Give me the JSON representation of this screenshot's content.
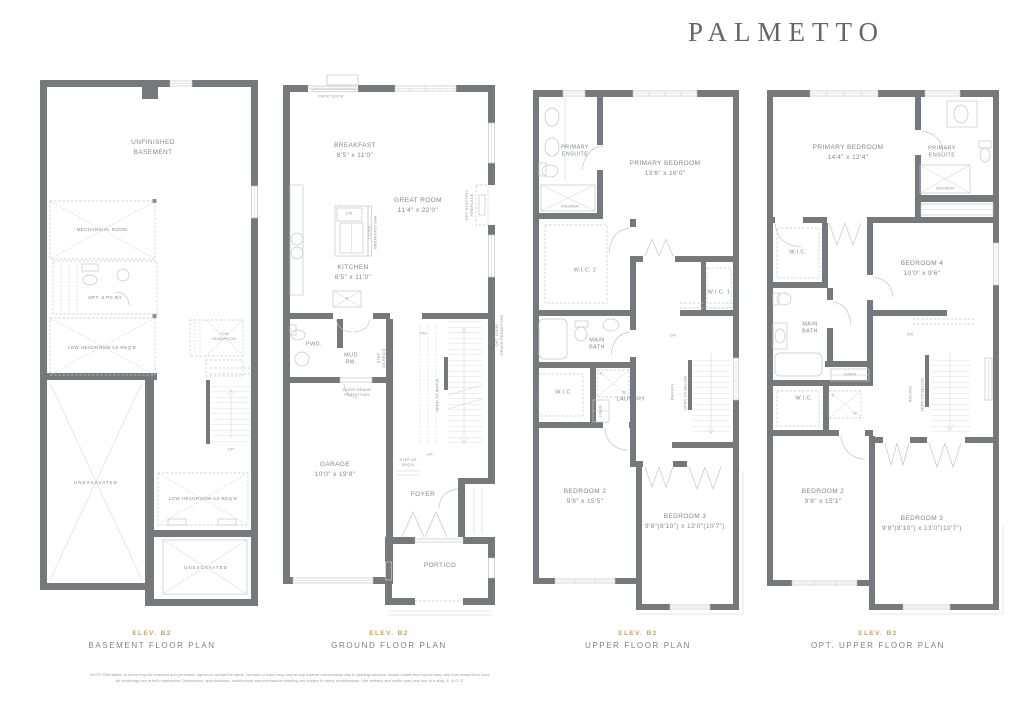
{
  "title": "PALMETTO",
  "colors": {
    "wall": "#75797b",
    "line": "#c2c6c8",
    "accent_gold": "#c5a35f",
    "label_text": "#83878a"
  },
  "footer": {
    "line1": "NOTE: Orientation of home may be reversed and purchaser agrees to accept the same. Number of risers may vary at any exterior entranceway due to grading variance. Actual usable floor space may vary from stated floor area.",
    "line2": "All renderings are artist's impression. Dimensions, specifications, architectural and mechanical detailing are subject to minor modifications. Site setback and soffits may vary due to e-bldg. E. & O. E."
  },
  "plans": {
    "basement": {
      "elev": "ELEV. B2",
      "name": "BASEMENT FLOOR PLAN",
      "labels": {
        "unfinished": "UNFINISHED\nBASEMENT",
        "mechanical": "MECHANICAL ROOM",
        "opt3pc": "OPT. 3 PC R/I",
        "lowheadroom_left": "LOW HEADROOM AS REQ'D",
        "lowheadroom_small": "LOW\nHEADROOM",
        "unexcavated_left": "UNEXCAVATED",
        "up": "UP",
        "lowheadroom_right": "LOW HEADROOM AS REQ'D",
        "unexcavated_bottom": "UNEXCAVATED"
      }
    },
    "ground": {
      "elev": "ELEV. B2",
      "name": "GROUND FLOOR PLAN",
      "labels": {
        "patio_door": "PATIO DOOR",
        "breakfast": "BREAKFAST\n8'5\" x 11'0\"",
        "great_room": "GREAT ROOM\n11'4\" x 22'0\"",
        "kitchen": "KITCHEN\n8'5\" x 11'0\"",
        "dw": "DW",
        "flush": "FLUSH",
        "breakfast_bar": "BREAKFAST BAR",
        "fridge": "F",
        "opt_fireplace": "OPT. ELECTRIC\nFIREPLACE",
        "pwd": "PWD.",
        "mud": "MUD\nRM.",
        "step_req_mud": "STEP\nAS REQ'D",
        "door_grade": "DOOR GRADE\nPERMITTING",
        "garage": "GARAGE\n10'0\" x 19'8\"",
        "dn": "DN",
        "open_above": "OPEN TO ABOVE",
        "up": "UP",
        "step_req_foyer": "STEP AS\nREQ'D",
        "opt_door_grade": "OPT. DOOR\nGRADE PERMITTING",
        "foyer": "FOYER",
        "portico": "PORTICO"
      }
    },
    "upper": {
      "elev": "ELEV. B2",
      "name": "UPPER FLOOR PLAN",
      "labels": {
        "primary_ensuite": "PRIMARY\nENSUITE",
        "primary_bedroom": "PRIMARY BEDROOM\n13'6\" x 16'0\"",
        "shower": "SHOWER",
        "wic2": "W.I.C. 2",
        "wic1": "W.I.C. 1",
        "main_bath": "MAIN\nBATH",
        "wic": "W.I.C",
        "laundry": "LAUNDRY",
        "linen": "LINEN",
        "dryer": "D",
        "washer": "W",
        "dn": "DN",
        "railing": "RAILING",
        "open_below": "OPEN TO BELOW",
        "bedroom2": "BEDROOM 2\n9'8\" x 15'5\"",
        "bedroom3": "BEDROOM 3\n9'8\"(8'10\") x 13'0\"(10'7\")"
      }
    },
    "opt_upper": {
      "elev": "ELEV. B2",
      "name": "OPT. UPPER FLOOR PLAN",
      "labels": {
        "primary_bedroom": "PRIMARY BEDROOM\n14'4\" x 12'4\"",
        "primary_ensuite": "PRIMARY\nENSUITE",
        "shower": "SHOWER",
        "wic_primary": "W.I.C.",
        "bedroom4": "BEDROOM 4\n10'0\" x 9'6\"",
        "main_bath": "MAIN\nBATH",
        "linen": "LINEN",
        "wic": "W.I.C.",
        "dryer": "D",
        "washer": "W",
        "dn": "DN",
        "railing": "RAILING",
        "open_below": "OPEN TO BELOW",
        "bedroom2": "BEDROOM 2\n9'8\" x 15'1\"",
        "bedroom3": "BEDROOM 3\n9'8\"(8'10\") x 13'0\"(10'7\")"
      }
    }
  }
}
